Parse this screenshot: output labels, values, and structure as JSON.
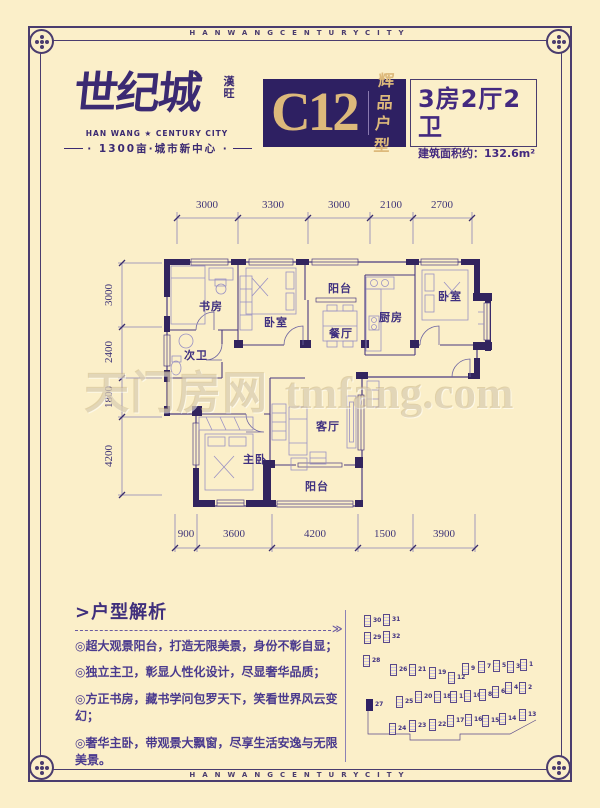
{
  "page": {
    "background": "#fbefc9",
    "frame_color": "#4a3c6e",
    "accent_purple": "#2e2062",
    "accent_gold": "#ddb97b"
  },
  "border": {
    "top_text": "HANWANGCENTURYCITY",
    "bottom_text": "HANWANGCENTURYCITY"
  },
  "header": {
    "logo": {
      "cn": "世纪城",
      "seal": "漢旺",
      "en": "HAN WANG ★ CENTURY CITY",
      "slogan": "· 1300亩·城市新中心 ·"
    },
    "unit": {
      "code": "C12",
      "tag_line1": "辉品",
      "tag_line2": "户型"
    },
    "info": {
      "layout": "3房2厅2卫",
      "area": "建筑面积约：132.6m²"
    }
  },
  "plan": {
    "dims_top": [
      "3000",
      "3300",
      "3000",
      "2100",
      "2700"
    ],
    "dims_left": [
      "3000",
      "2400",
      "1800",
      "4200"
    ],
    "dims_bottom": [
      "900",
      "3600",
      "4200",
      "1500",
      "3900"
    ],
    "rooms": [
      {
        "name": "书房"
      },
      {
        "name": "阳台"
      },
      {
        "name": "卧室"
      },
      {
        "name": "餐厅"
      },
      {
        "name": "厨房"
      },
      {
        "name": "卧室"
      },
      {
        "name": "次卫"
      },
      {
        "name": "主卧"
      },
      {
        "name": "客厅"
      },
      {
        "name": "阳台"
      }
    ]
  },
  "watermark": {
    "cn": "天门房网",
    "en": "tmfang.com"
  },
  "analysis": {
    "title": ">户型解析",
    "arrow": "≫",
    "items": [
      "◎超大观景阳台，打造无限美景，身份不彰自显；",
      "◎独立主卫，彰显人性化设计，尽显奢华品质；",
      "◎方正书房，藏书学问包罗天下，笑看世界风云变幻；",
      "◎奢华主卧，带观景大飘窗，尽享生活安逸与无限美景。"
    ]
  },
  "site_plan": {
    "highlighted_building": "27",
    "buildings": [
      {
        "n": "30",
        "x": 14,
        "y": 15,
        "hl": false
      },
      {
        "n": "31",
        "x": 33,
        "y": 14,
        "hl": false
      },
      {
        "n": "29",
        "x": 14,
        "y": 32,
        "hl": false
      },
      {
        "n": "32",
        "x": 33,
        "y": 31,
        "hl": false
      },
      {
        "n": "28",
        "x": 13,
        "y": 55,
        "hl": false
      },
      {
        "n": "26",
        "x": 40,
        "y": 64,
        "hl": false
      },
      {
        "n": "21",
        "x": 59,
        "y": 64,
        "hl": false
      },
      {
        "n": "19",
        "x": 79,
        "y": 67,
        "hl": false
      },
      {
        "n": "12",
        "x": 98,
        "y": 72,
        "hl": false
      },
      {
        "n": "9",
        "x": 112,
        "y": 63,
        "hl": false
      },
      {
        "n": "7",
        "x": 128,
        "y": 61,
        "hl": false
      },
      {
        "n": "5",
        "x": 143,
        "y": 60,
        "hl": false
      },
      {
        "n": "3",
        "x": 157,
        "y": 61,
        "hl": false
      },
      {
        "n": "1",
        "x": 170,
        "y": 59,
        "hl": false
      },
      {
        "n": "27",
        "x": 16,
        "y": 99,
        "hl": true
      },
      {
        "n": "25",
        "x": 46,
        "y": 96,
        "hl": false
      },
      {
        "n": "20",
        "x": 65,
        "y": 91,
        "hl": false
      },
      {
        "n": "18",
        "x": 84,
        "y": 91,
        "hl": false
      },
      {
        "n": "11",
        "x": 100,
        "y": 91,
        "hl": false
      },
      {
        "n": "10",
        "x": 114,
        "y": 90,
        "hl": false
      },
      {
        "n": "8",
        "x": 129,
        "y": 89,
        "hl": false
      },
      {
        "n": "6",
        "x": 142,
        "y": 86,
        "hl": false
      },
      {
        "n": "4",
        "x": 155,
        "y": 82,
        "hl": false
      },
      {
        "n": "2",
        "x": 169,
        "y": 82,
        "hl": false
      },
      {
        "n": "24",
        "x": 39,
        "y": 123,
        "hl": false
      },
      {
        "n": "23",
        "x": 59,
        "y": 120,
        "hl": false
      },
      {
        "n": "22",
        "x": 79,
        "y": 119,
        "hl": false
      },
      {
        "n": "17",
        "x": 97,
        "y": 115,
        "hl": false
      },
      {
        "n": "16",
        "x": 115,
        "y": 114,
        "hl": false
      },
      {
        "n": "15",
        "x": 132,
        "y": 115,
        "hl": false
      },
      {
        "n": "14",
        "x": 149,
        "y": 113,
        "hl": false
      },
      {
        "n": "13",
        "x": 169,
        "y": 109,
        "hl": false
      }
    ]
  }
}
